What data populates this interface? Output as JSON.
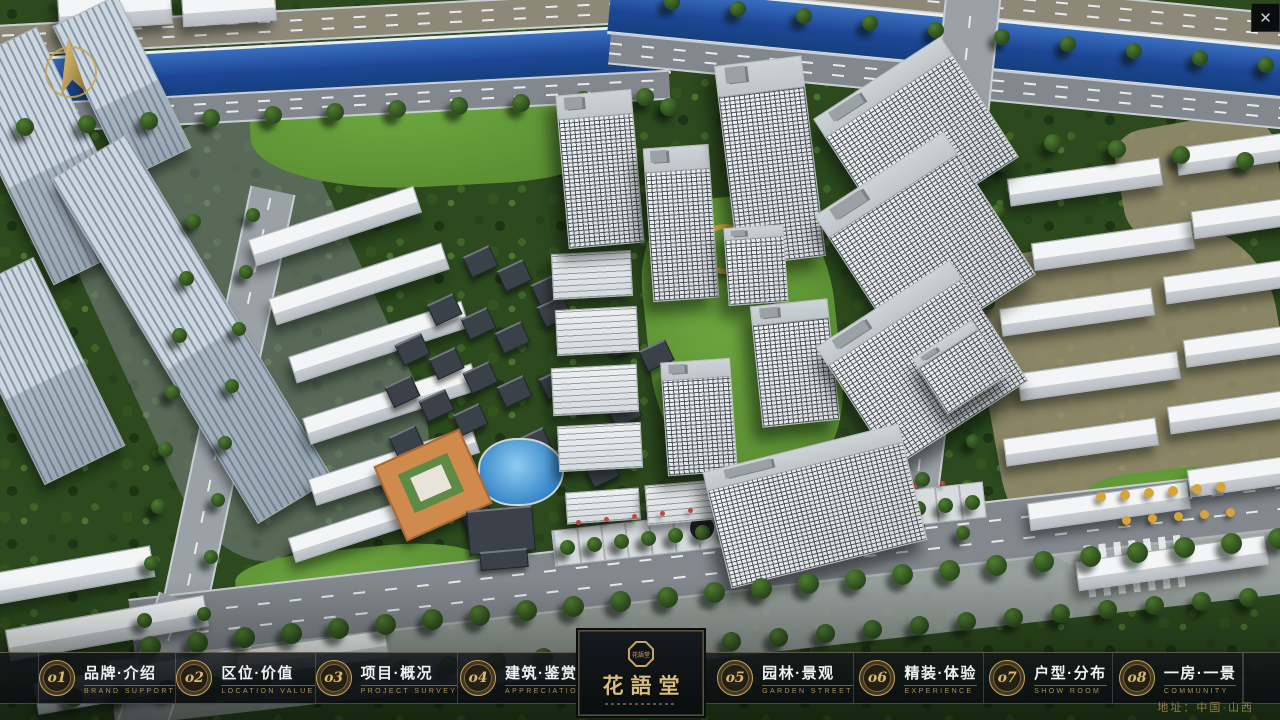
{
  "window": {
    "close_label": "✕"
  },
  "logo": {
    "title": "花語堂",
    "seal_text": "花語堂"
  },
  "nav": {
    "items": [
      {
        "num": "o1",
        "zh": "品牌·介绍",
        "en": "BRAND SUPPORT"
      },
      {
        "num": "o2",
        "zh": "区位·价值",
        "en": "LOCATION VALUE"
      },
      {
        "num": "o3",
        "zh": "项目·概况",
        "en": "PROJECT SURVEY"
      },
      {
        "num": "o4",
        "zh": "建筑·鉴赏",
        "en": "APPRECIATION"
      },
      {
        "num": "o5",
        "zh": "园林·景观",
        "en": "GARDEN STREET"
      },
      {
        "num": "o6",
        "zh": "精装·体验",
        "en": "EXPERIENCE"
      },
      {
        "num": "o7",
        "zh": "户型·分布",
        "en": "SHOW ROOM"
      },
      {
        "num": "o8",
        "zh": "一房·一景",
        "en": "COMMUNITY"
      }
    ]
  },
  "footer": {
    "address": "地址：中国·山西"
  },
  "colors": {
    "accent_gold": "#c9a95e",
    "bar_background": "#11151a",
    "river_blue": "#1c4694",
    "foliage_green": "#2c4a1e",
    "building_white": "#e9edf0"
  },
  "scene": {
    "elements": [
      {
        "c": "gray",
        "x": 120,
        "y": 120,
        "w": 260,
        "h": 430,
        "r": -25
      },
      {
        "c": "dirt",
        "x": 990,
        "y": 235,
        "w": 300,
        "h": 330,
        "r": -10
      },
      {
        "c": "dirt",
        "x": 1120,
        "y": 120,
        "w": 160,
        "h": 120,
        "r": -10
      },
      {
        "c": "lawn",
        "x": 250,
        "y": 58,
        "w": 380,
        "h": 128,
        "r": -3
      },
      {
        "c": "lawn",
        "x": 648,
        "y": 196,
        "w": 190,
        "h": 290,
        "r": -6
      },
      {
        "c": "lawn",
        "x": 960,
        "y": 36,
        "w": 150,
        "h": 62,
        "r": -8
      },
      {
        "c": "lawn",
        "x": 1080,
        "y": 470,
        "w": 170,
        "h": 80,
        "r": -7
      },
      {
        "c": "lawn",
        "x": 236,
        "y": 548,
        "w": 250,
        "h": 70,
        "r": -6
      },
      {
        "c": "road-h tan",
        "x": -30,
        "y": 8,
        "w": 700,
        "h": 28,
        "r": -3
      },
      {
        "c": "road-h tan",
        "x": 608,
        "y": -18,
        "w": 700,
        "h": 30,
        "r": 5.5
      },
      {
        "c": "riverband",
        "x": -30,
        "y": 42,
        "w": 700,
        "h": 44,
        "r": -3
      },
      {
        "c": "riverband",
        "x": 608,
        "y": 16,
        "w": 706,
        "h": 46,
        "r": 5.5
      },
      {
        "c": "road-h",
        "x": -30,
        "y": 88,
        "w": 700,
        "h": 26,
        "r": -3
      },
      {
        "c": "road-h",
        "x": 608,
        "y": 66,
        "w": 700,
        "h": 28,
        "r": 5.5
      },
      {
        "c": "road-v",
        "x": 938,
        "y": -24,
        "w": 52,
        "h": 180,
        "r": 6
      },
      {
        "c": "road-v",
        "x": 912,
        "y": 136,
        "w": 40,
        "h": 432,
        "r": 7
      },
      {
        "c": "road-v",
        "x": 198,
        "y": 185,
        "w": 42,
        "h": 500,
        "r": 12
      },
      {
        "c": "road-h",
        "x": 128,
        "y": 530,
        "w": 1215,
        "h": 58,
        "r": -6.5
      },
      {
        "c": "walk",
        "x": 108,
        "y": 592,
        "w": 1220,
        "h": 66,
        "r": -6.5
      },
      {
        "c": "road-v",
        "x": 136,
        "y": 596,
        "w": 46,
        "h": 140,
        "r": 18
      },
      {
        "c": "zebra",
        "x": 1086,
        "y": 540,
        "w": 100,
        "h": 52,
        "r": -6.5
      },
      {
        "c": "slab",
        "x": 58,
        "y": -8,
        "w": 112,
        "h": 34,
        "r": -4
      },
      {
        "c": "slab",
        "x": 182,
        "y": -8,
        "w": 92,
        "h": 30,
        "r": -4
      },
      {
        "c": "slab blu",
        "x": -4,
        "y": 36,
        "w": 96,
        "h": 238,
        "r": -26
      },
      {
        "c": "slab blu",
        "x": 86,
        "y": 2,
        "w": 70,
        "h": 168,
        "r": -26
      },
      {
        "c": "slab blu",
        "x": -6,
        "y": 266,
        "w": 88,
        "h": 208,
        "r": -26
      },
      {
        "c": "slab blu",
        "x": 148,
        "y": 128,
        "w": 86,
        "h": 400,
        "r": -31
      },
      {
        "c": "slab",
        "x": 248,
        "y": 212,
        "w": 172,
        "h": 26,
        "r": -18
      },
      {
        "c": "slab",
        "x": 268,
        "y": 270,
        "w": 180,
        "h": 26,
        "r": -18
      },
      {
        "c": "slab",
        "x": 288,
        "y": 328,
        "w": 180,
        "h": 26,
        "r": -18
      },
      {
        "c": "slab",
        "x": 302,
        "y": 390,
        "w": 176,
        "h": 26,
        "r": -18
      },
      {
        "c": "slab",
        "x": 308,
        "y": 452,
        "w": 170,
        "h": 26,
        "r": -18
      },
      {
        "c": "slab",
        "x": 288,
        "y": 514,
        "w": 150,
        "h": 24,
        "r": -18
      },
      {
        "c": "slab",
        "x": -18,
        "y": 560,
        "w": 170,
        "h": 30,
        "r": -10
      },
      {
        "c": "slab",
        "x": 6,
        "y": 612,
        "w": 200,
        "h": 30,
        "r": -10
      },
      {
        "c": "slab",
        "x": 34,
        "y": 664,
        "w": 220,
        "h": 30,
        "r": -10
      },
      {
        "c": "slab",
        "x": 236,
        "y": 640,
        "w": 150,
        "h": 26,
        "r": -8
      },
      {
        "c": "slab",
        "x": 1008,
        "y": 168,
        "w": 152,
        "h": 26,
        "r": -8
      },
      {
        "c": "slab",
        "x": 1176,
        "y": 138,
        "w": 140,
        "h": 26,
        "r": -8
      },
      {
        "c": "slab",
        "x": 1032,
        "y": 232,
        "w": 160,
        "h": 26,
        "r": -8
      },
      {
        "c": "slab",
        "x": 1192,
        "y": 202,
        "w": 132,
        "h": 26,
        "r": -8
      },
      {
        "c": "slab",
        "x": 1000,
        "y": 298,
        "w": 152,
        "h": 26,
        "r": -8
      },
      {
        "c": "slab",
        "x": 1164,
        "y": 266,
        "w": 150,
        "h": 26,
        "r": -8
      },
      {
        "c": "slab",
        "x": 1018,
        "y": 362,
        "w": 160,
        "h": 26,
        "r": -8
      },
      {
        "c": "slab",
        "x": 1184,
        "y": 330,
        "w": 140,
        "h": 26,
        "r": -8
      },
      {
        "c": "slab",
        "x": 1004,
        "y": 428,
        "w": 152,
        "h": 26,
        "r": -8
      },
      {
        "c": "slab",
        "x": 1168,
        "y": 396,
        "w": 150,
        "h": 26,
        "r": -8
      },
      {
        "c": "slab",
        "x": 1028,
        "y": 492,
        "w": 160,
        "h": 26,
        "r": -8
      },
      {
        "c": "slab",
        "x": 1188,
        "y": 460,
        "w": 140,
        "h": 26,
        "r": -8
      },
      {
        "c": "slab",
        "x": 1076,
        "y": 548,
        "w": 190,
        "h": 28,
        "r": -8
      },
      {
        "c": "court",
        "x": 430,
        "y": 298,
        "w": 27,
        "h": 20,
        "r": -25
      },
      {
        "c": "court",
        "x": 464,
        "y": 312,
        "w": 27,
        "h": 20,
        "r": -25
      },
      {
        "c": "court",
        "x": 498,
        "y": 326,
        "w": 27,
        "h": 20,
        "r": -25
      },
      {
        "c": "court",
        "x": 466,
        "y": 250,
        "w": 27,
        "h": 20,
        "r": -25
      },
      {
        "c": "court",
        "x": 500,
        "y": 264,
        "w": 27,
        "h": 20,
        "r": -25
      },
      {
        "c": "court",
        "x": 534,
        "y": 278,
        "w": 27,
        "h": 20,
        "r": -25
      },
      {
        "c": "court",
        "x": 398,
        "y": 338,
        "w": 27,
        "h": 20,
        "r": -25
      },
      {
        "c": "court",
        "x": 432,
        "y": 352,
        "w": 27,
        "h": 20,
        "r": -25
      },
      {
        "c": "court",
        "x": 466,
        "y": 366,
        "w": 27,
        "h": 20,
        "r": -25
      },
      {
        "c": "court",
        "x": 500,
        "y": 380,
        "w": 27,
        "h": 20,
        "r": -25
      },
      {
        "c": "court",
        "x": 388,
        "y": 380,
        "w": 27,
        "h": 20,
        "r": -25
      },
      {
        "c": "court",
        "x": 422,
        "y": 394,
        "w": 27,
        "h": 20,
        "r": -25
      },
      {
        "c": "court",
        "x": 456,
        "y": 408,
        "w": 27,
        "h": 20,
        "r": -25
      },
      {
        "c": "court",
        "x": 392,
        "y": 430,
        "w": 27,
        "h": 20,
        "r": -25
      },
      {
        "c": "court",
        "x": 426,
        "y": 444,
        "w": 27,
        "h": 20,
        "r": -25
      },
      {
        "c": "court",
        "x": 396,
        "y": 480,
        "w": 27,
        "h": 20,
        "r": -25
      },
      {
        "c": "court",
        "x": 430,
        "y": 494,
        "w": 27,
        "h": 20,
        "r": -25
      },
      {
        "c": "court",
        "x": 464,
        "y": 508,
        "w": 27,
        "h": 20,
        "r": -25
      },
      {
        "c": "court",
        "x": 540,
        "y": 300,
        "w": 27,
        "h": 20,
        "r": -25
      },
      {
        "c": "court",
        "x": 574,
        "y": 314,
        "w": 27,
        "h": 20,
        "r": -25
      },
      {
        "c": "court",
        "x": 542,
        "y": 372,
        "w": 27,
        "h": 20,
        "r": -25
      },
      {
        "c": "court",
        "x": 576,
        "y": 386,
        "w": 27,
        "h": 20,
        "r": -25
      },
      {
        "c": "court",
        "x": 610,
        "y": 400,
        "w": 27,
        "h": 20,
        "r": -25
      },
      {
        "c": "court",
        "x": 520,
        "y": 432,
        "w": 27,
        "h": 20,
        "r": -25
      },
      {
        "c": "court",
        "x": 554,
        "y": 446,
        "w": 27,
        "h": 20,
        "r": -25
      },
      {
        "c": "court",
        "x": 588,
        "y": 460,
        "w": 27,
        "h": 20,
        "r": -25
      },
      {
        "c": "court",
        "x": 608,
        "y": 330,
        "w": 27,
        "h": 20,
        "r": -25
      },
      {
        "c": "court",
        "x": 642,
        "y": 344,
        "w": 27,
        "h": 20,
        "r": -25
      },
      {
        "c": "pool",
        "x": 478,
        "y": 438,
        "w": 82,
        "h": 64,
        "r": 0
      },
      {
        "c": "orange",
        "x": 386,
        "y": 444,
        "w": 90,
        "h": 78,
        "r": -24,
        "col": "#cf8a4c"
      },
      {
        "c": "flat",
        "x": 404,
        "y": 462,
        "w": 54,
        "h": 42,
        "r": -24,
        "col": "#5d8a44"
      },
      {
        "c": "flat",
        "x": 414,
        "y": 470,
        "w": 34,
        "h": 26,
        "r": -24,
        "col": "#e8e4da"
      },
      {
        "c": "court",
        "x": 468,
        "y": 508,
        "w": 64,
        "h": 42,
        "r": -5
      },
      {
        "c": "court",
        "x": 480,
        "y": 550,
        "w": 46,
        "h": 16,
        "r": -5
      },
      {
        "c": "ring",
        "x": 700,
        "y": 224,
        "w": 40,
        "h": 40,
        "r": 0
      },
      {
        "c": "mid",
        "x": 552,
        "y": 252,
        "w": 78,
        "h": 44,
        "r": -3
      },
      {
        "c": "mid",
        "x": 556,
        "y": 308,
        "w": 80,
        "h": 44,
        "r": -3
      },
      {
        "c": "mid",
        "x": 552,
        "y": 366,
        "w": 84,
        "h": 46,
        "r": -3
      },
      {
        "c": "mid",
        "x": 558,
        "y": 424,
        "w": 82,
        "h": 44,
        "r": -3
      },
      {
        "c": "tree",
        "x": 16,
        "y": 118,
        "n": 11,
        "dx": 62,
        "dy": -3,
        "s": 18
      },
      {
        "c": "tree",
        "x": 660,
        "y": 98,
        "n": 10,
        "dx": 64,
        "dy": 6,
        "s": 18
      },
      {
        "c": "tree",
        "x": 664,
        "y": -6,
        "n": 10,
        "dx": 66,
        "dy": 7,
        "s": 16
      },
      {
        "c": "tree",
        "x": 950,
        "y": 150,
        "n": 9,
        "dx": -5,
        "dy": 46,
        "s": 15
      },
      {
        "c": "tree",
        "x": 996,
        "y": 158,
        "n": 9,
        "dx": -5,
        "dy": 46,
        "s": 14
      },
      {
        "c": "tree",
        "x": 186,
        "y": 214,
        "n": 8,
        "dx": -7,
        "dy": 57,
        "s": 15
      },
      {
        "c": "tree",
        "x": 246,
        "y": 208,
        "n": 8,
        "dx": -7,
        "dy": 57,
        "s": 14
      },
      {
        "c": "plaza",
        "x": 552,
        "y": 506,
        "w": 432,
        "h": 34,
        "r": -6.5
      },
      {
        "c": "disc",
        "x": 686,
        "y": 512,
        "w": 24,
        "h": 24,
        "r": 0,
        "col": "#1e2428"
      },
      {
        "c": "mid",
        "x": 566,
        "y": 490,
        "w": 72,
        "h": 30,
        "r": -4
      },
      {
        "c": "mid",
        "x": 646,
        "y": 482,
        "w": 78,
        "h": 38,
        "r": -5
      },
      {
        "c": "tree",
        "x": 560,
        "y": 540,
        "n": 16,
        "dx": 27,
        "dy": -3,
        "s": 15
      },
      {
        "c": "dot",
        "x": 576,
        "y": 520,
        "n": 14,
        "dx": 28,
        "dy": -3,
        "s": 5,
        "col": "#c2483e"
      },
      {
        "c": "dot",
        "x": 1096,
        "y": 492,
        "n": 6,
        "dx": 24,
        "dy": -2,
        "s": 10,
        "col": "#d7a43a"
      },
      {
        "c": "dot",
        "x": 1122,
        "y": 516,
        "n": 5,
        "dx": 26,
        "dy": -2,
        "s": 9,
        "col": "#d7a43a"
      },
      {
        "c": "tower",
        "x": 562,
        "y": 92,
        "w": 74,
        "h": 152,
        "r": -5
      },
      {
        "c": "tower",
        "x": 648,
        "y": 146,
        "w": 64,
        "h": 152,
        "r": -4
      },
      {
        "c": "tower",
        "x": 726,
        "y": 60,
        "w": 86,
        "h": 200,
        "r": -7
      },
      {
        "c": "tower",
        "x": 840,
        "y": 66,
        "w": 150,
        "h": 142,
        "r": -33
      },
      {
        "c": "tower",
        "x": 848,
        "y": 160,
        "w": 152,
        "h": 168,
        "r": -33
      },
      {
        "c": "tower",
        "x": 726,
        "y": 226,
        "w": 58,
        "h": 76,
        "r": -4
      },
      {
        "c": "tower",
        "x": 756,
        "y": 302,
        "w": 76,
        "h": 120,
        "r": -6
      },
      {
        "c": "tower",
        "x": 842,
        "y": 292,
        "w": 158,
        "h": 142,
        "r": -33
      },
      {
        "c": "tower",
        "x": 924,
        "y": 334,
        "w": 70,
        "h": 64,
        "r": -33
      },
      {
        "c": "tower",
        "x": 664,
        "y": 360,
        "w": 68,
        "h": 112,
        "r": -4
      },
      {
        "c": "tower",
        "x": 714,
        "y": 446,
        "w": 200,
        "h": 118,
        "r": -14
      },
      {
        "c": "tree",
        "x": 140,
        "y": 636,
        "n": 25,
        "dx": 47,
        "dy": -4.5,
        "s": 21
      },
      {
        "c": "tree",
        "x": 64,
        "y": 688,
        "n": 26,
        "dx": 47,
        "dy": -4,
        "s": 19
      }
    ]
  }
}
